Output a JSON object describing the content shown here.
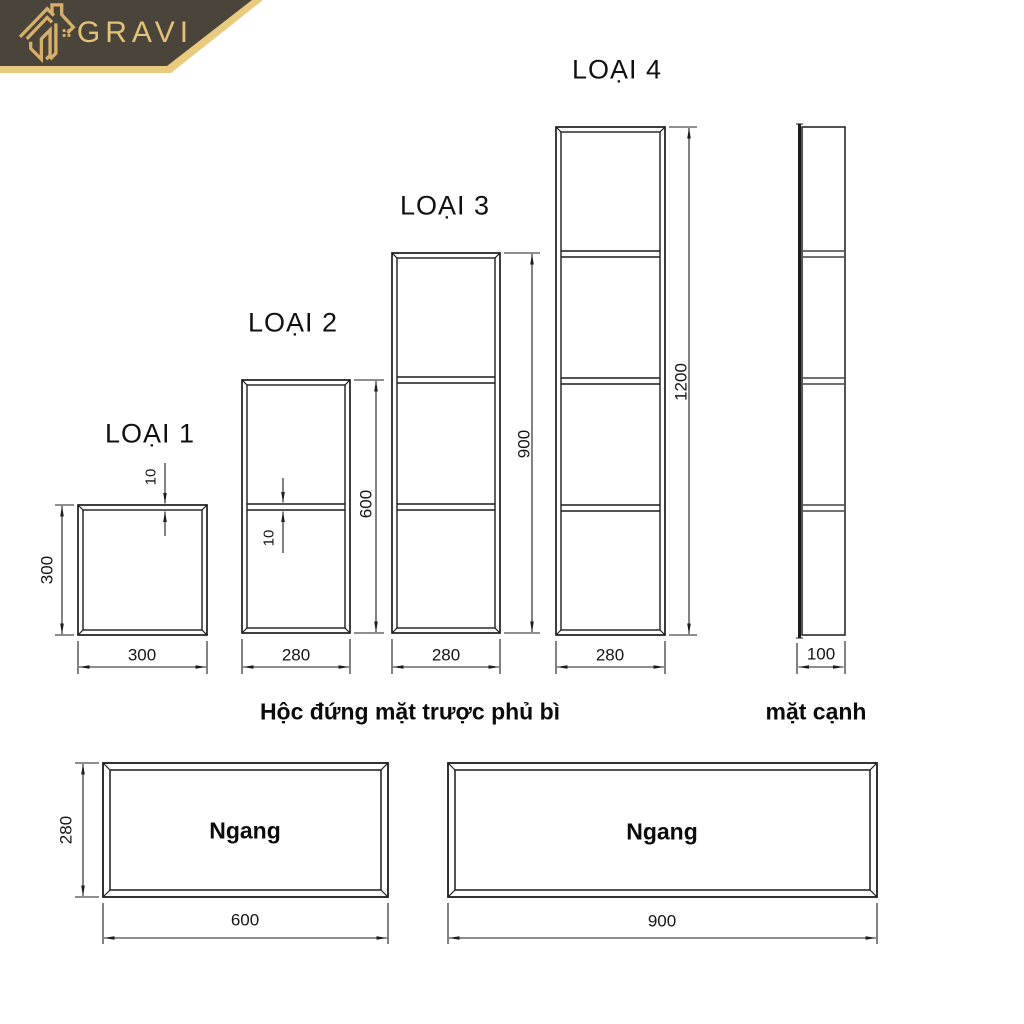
{
  "brand": {
    "name": "GRAVI"
  },
  "captions": {
    "front": "Hộc đứng mặt trược phủ bì",
    "side": "mặt cạnh"
  },
  "types": {
    "loai1": {
      "title": "LOẠI 1",
      "width": "300",
      "height": "300",
      "frame_thickness": "10"
    },
    "loai2": {
      "title": "LOẠI 2",
      "width": "280",
      "height": "600",
      "shelf_thickness": "10"
    },
    "loai3": {
      "title": "LOẠI 3",
      "width": "280",
      "height": "900"
    },
    "loai4": {
      "title": "LOẠI 4",
      "width": "280",
      "height": "1200"
    },
    "side_view": {
      "width": "100"
    }
  },
  "horizontal_boxes": {
    "box1": {
      "label": "Ngang",
      "width": "600",
      "height": "280"
    },
    "box2": {
      "label": "Ngang",
      "width": "900"
    }
  },
  "colors": {
    "banner": "#4b443b",
    "gold": "#d6b06a",
    "gold_stripe": "#e8cb7e",
    "line": "#1c1c1c"
  }
}
